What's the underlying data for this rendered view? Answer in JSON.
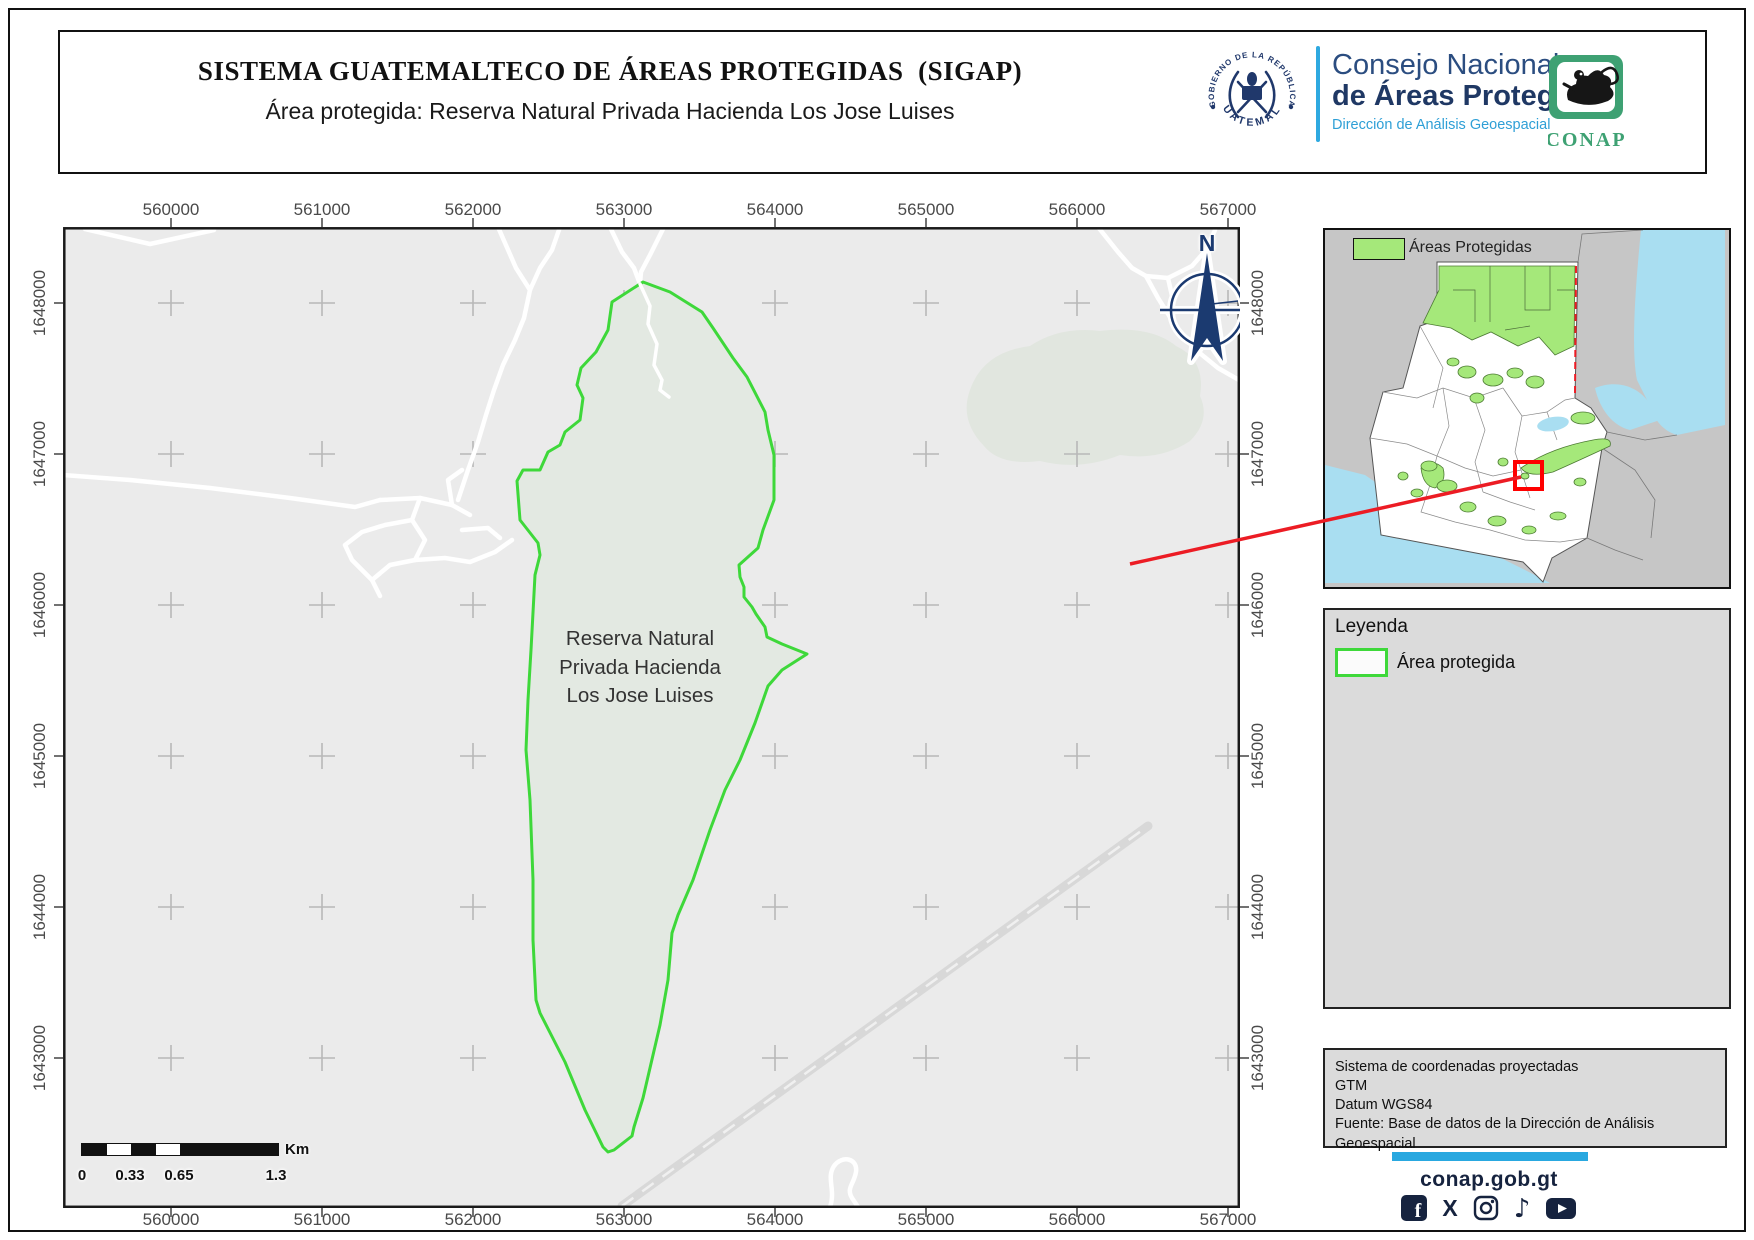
{
  "header": {
    "title": "SISTEMA GUATEMALTECO DE ÁREAS PROTEGIDAS  (SIGAP)",
    "subtitle": "Área protegida: Reserva Natural Privada Hacienda Los Jose Luises",
    "gov_seal": {
      "top_text": "GOBIERNO DE LA REPÚBLICA",
      "bottom_text": "GUATEMALA"
    },
    "org": {
      "line1": "Consejo Nacional",
      "line2": "de Áreas Protegidas",
      "line3": "Dirección de Análisis Geoespacial"
    },
    "conap_logo_text": "CONAP"
  },
  "map": {
    "area_label": "Reserva Natural\nPrivada Hacienda\nLos Jose Luises",
    "north_label": "N",
    "scalebar": {
      "labels": [
        "0",
        "0.33",
        "0.65",
        "1.3"
      ],
      "unit": "Km"
    }
  },
  "axes": {
    "x_labels": [
      "560000",
      "561000",
      "562000",
      "563000",
      "564000",
      "565000",
      "566000",
      "567000"
    ],
    "y_labels": [
      "1648000",
      "1647000",
      "1646000",
      "1645000",
      "1644000",
      "1643000"
    ]
  },
  "inset": {
    "legend_label": "Áreas Protegidas"
  },
  "legend": {
    "title": "Leyenda",
    "item_label": "Área protegida"
  },
  "credits": {
    "lines": [
      "Sistema de coordenadas proyectadas",
      "GTM",
      "Datum WGS84",
      "Fuente: Base de datos de la Dirección de Análisis Geoespacial"
    ]
  },
  "footer": {
    "website": "conap.gob.gt",
    "social": [
      "facebook",
      "x",
      "instagram",
      "tiktok",
      "youtube"
    ]
  },
  "colors": {
    "boundary_green": "#3ed83a",
    "navy": "#1b3a70",
    "light_blue": "#29a8e0",
    "inset_green": "#a5e87a",
    "sea_blue": "#a9def1",
    "red": "#ec1c24",
    "map_bg": "#ebebeb"
  }
}
